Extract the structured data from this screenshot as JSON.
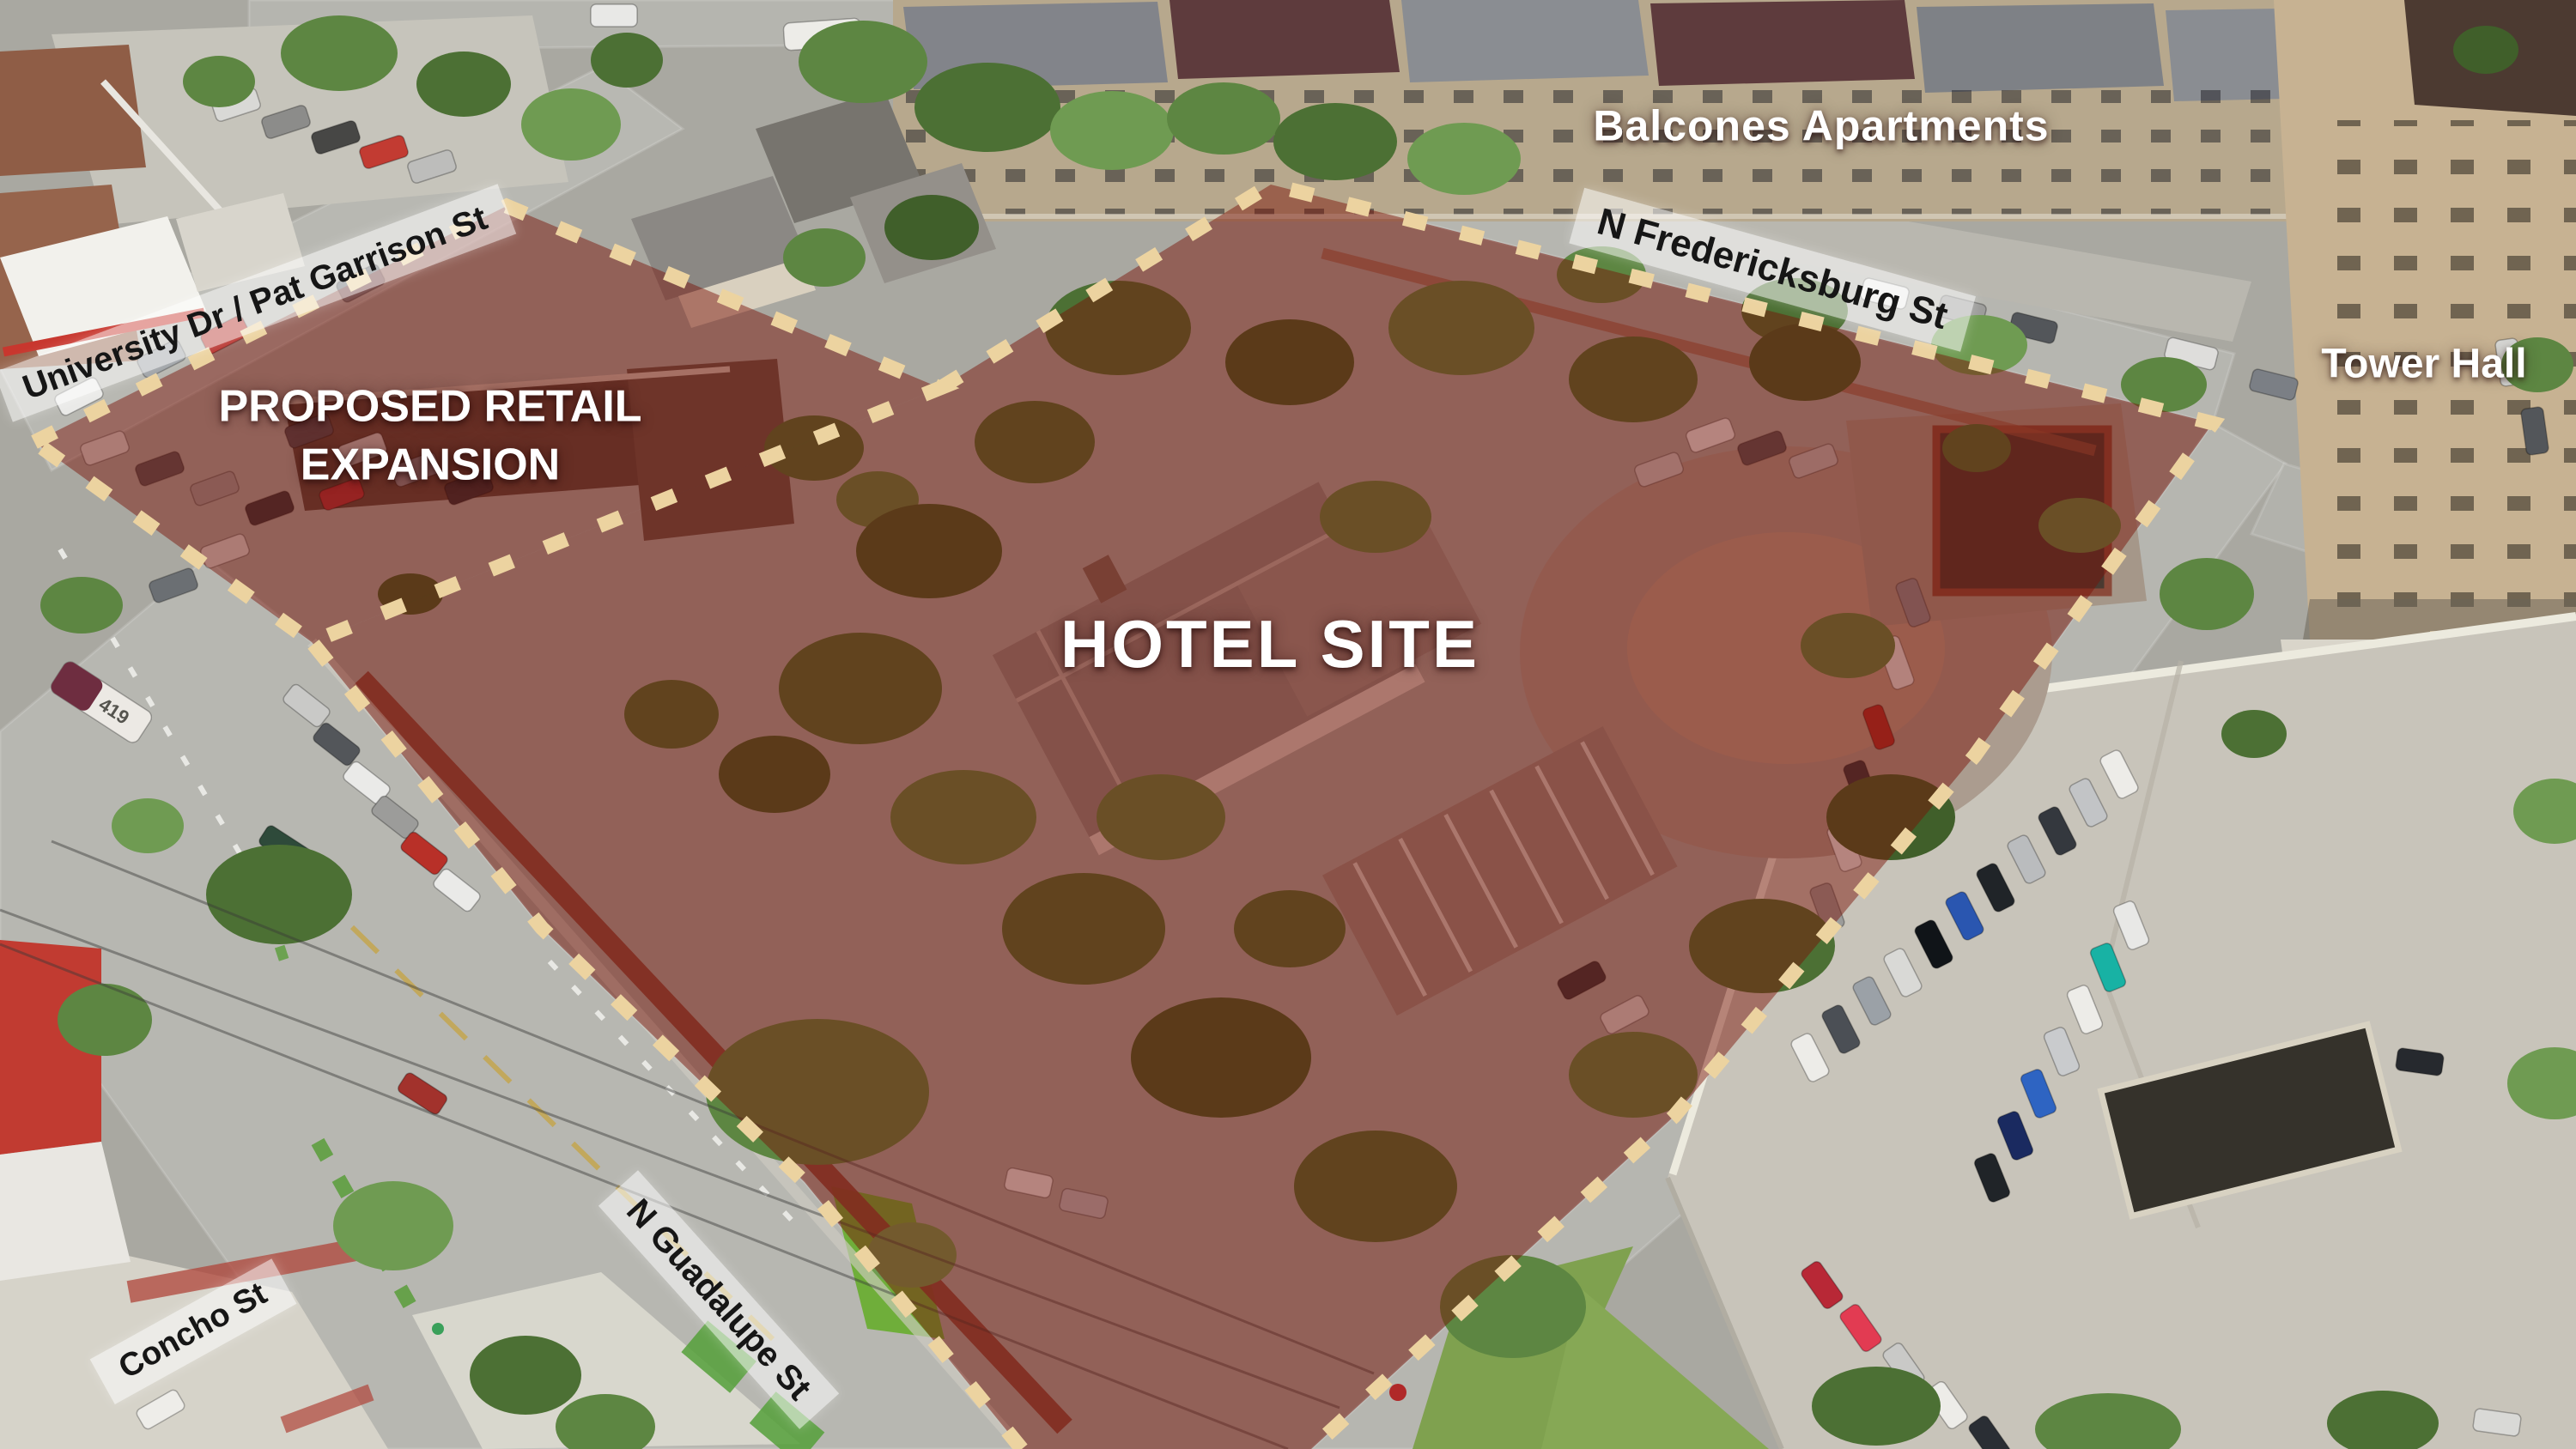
{
  "site_labels": {
    "hotel": "HOTEL SITE",
    "retail_line1": "PROPOSED RETAIL",
    "retail_line2": "EXPANSION"
  },
  "place_labels": {
    "balcones": "Balcones Apartments",
    "tower_hall": "Tower Hall"
  },
  "street_labels": {
    "university": "University Dr / Pat Garrison St",
    "fredericksburg": "N Fredericksburg St",
    "guadalupe": "N Guadalupe St",
    "concho": "Concho St"
  },
  "vehicle_text": {
    "bus_number": "419"
  },
  "parcels": [
    {
      "name": "Hotel site",
      "label": "HOTEL SITE"
    },
    {
      "name": "Proposed retail expansion",
      "label": "PROPOSED RETAIL EXPANSION"
    }
  ],
  "colors": {
    "overlay_fill": "rgba(122,16,6,0.47)",
    "boundary_dash": "#ecd3a0",
    "street_label_bg": "rgba(255,255,255,0.55)",
    "street_label_text": "#161616",
    "site_label_text": "#ffffff"
  }
}
